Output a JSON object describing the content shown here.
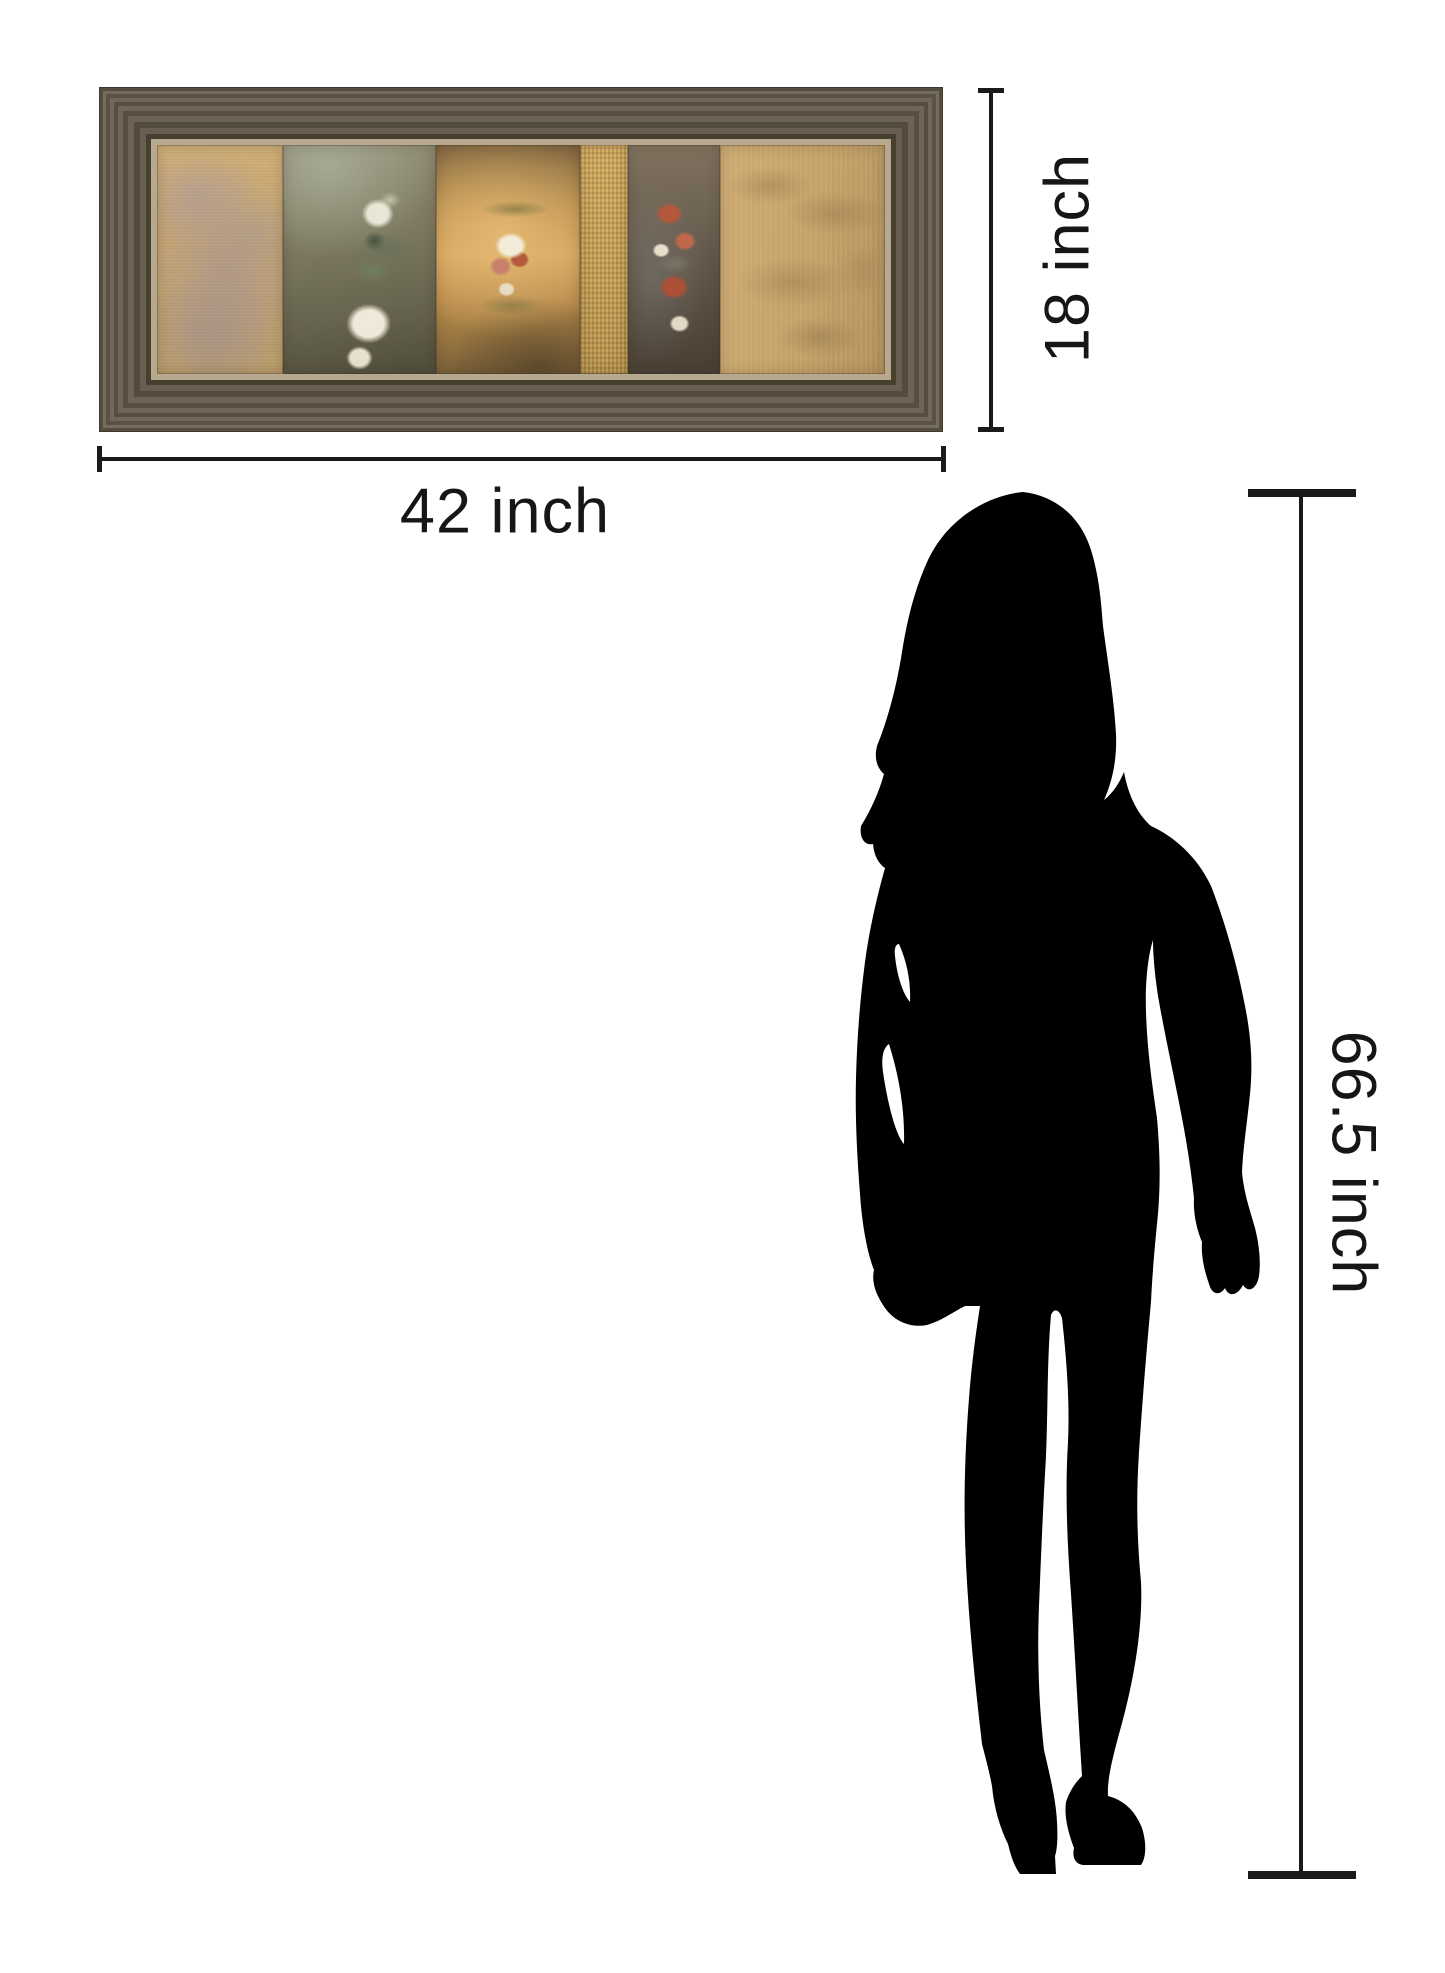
{
  "page": {
    "background": "#ffffff"
  },
  "product": {
    "name": "framed-panel-wall-art",
    "frame_wood_color": "#6b6254",
    "frame_liner_color": "#b7a98f",
    "panels": [
      {
        "name": "damask-tan-panel"
      },
      {
        "name": "olive-white-floral-panel"
      },
      {
        "name": "amber-floral-panel"
      },
      {
        "name": "gold-texture-strip"
      },
      {
        "name": "dark-coral-floral-panel"
      },
      {
        "name": "tan-leaf-shadow-panel"
      }
    ]
  },
  "dimensions": {
    "art_width": {
      "label": "42 inch"
    },
    "art_height": {
      "label": "18 inch"
    },
    "person_height": {
      "label": "66.5 inch"
    },
    "line_color": "#1a1a1a",
    "text_color": "#161616"
  },
  "figure": {
    "name": "woman-silhouette",
    "color": "#000000"
  }
}
